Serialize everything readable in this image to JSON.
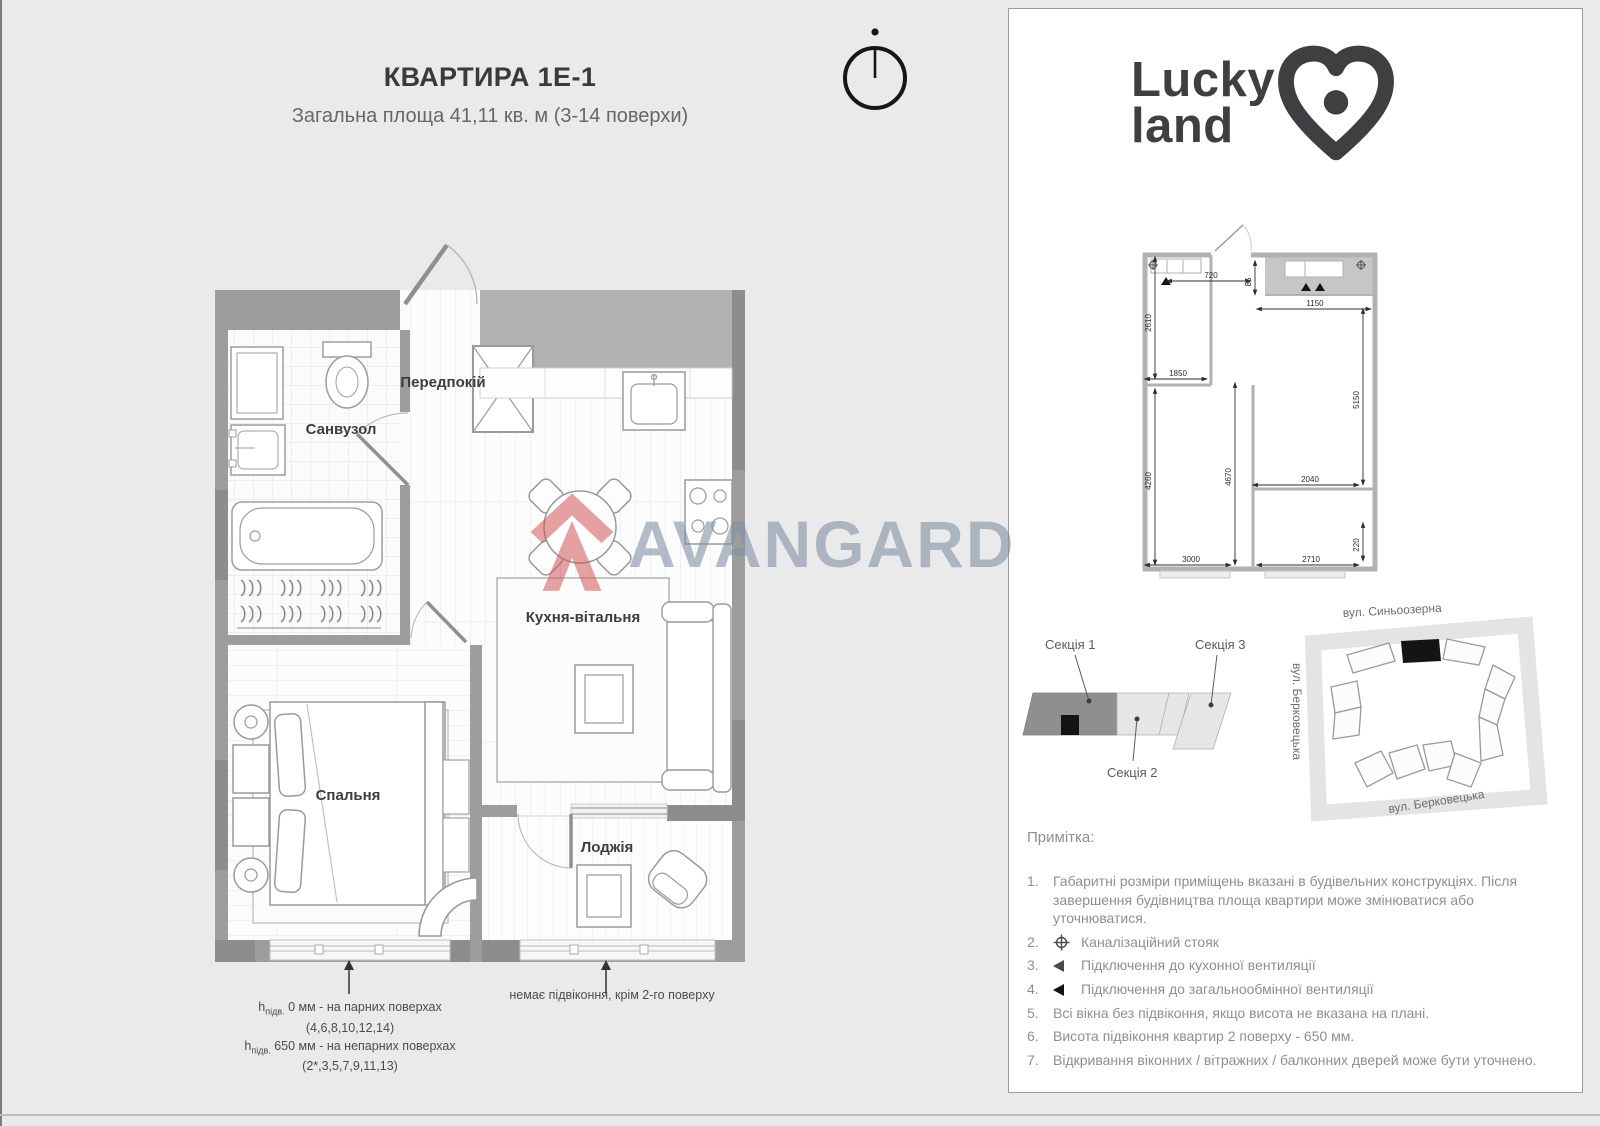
{
  "header": {
    "title": "КВАРТИРА 1Е-1",
    "subtitle": "Загальна площа 41,11 кв. м (3-14 поверхи)"
  },
  "floor_plan": {
    "rooms": {
      "hallway": "Передпокій",
      "bathroom": "Санвузол",
      "kitchen_living": "Кухня-вітальня",
      "bedroom": "Спальня",
      "loggia": "Лоджія"
    },
    "sill_notes": {
      "h": "h",
      "h_sub": "підв.",
      "left_line1": " 0 мм - на парних поверхах",
      "left_line1_floors": "(4,6,8,10,12,14)",
      "left_line2": " 650 мм - на непарних поверхах",
      "left_line2_floors": "(2*,3,5,7,9,11,13)",
      "right": "немає підвіконня, крім 2-го поверху"
    }
  },
  "watermark": {
    "brand": "AVANGARD"
  },
  "brand_panel": {
    "logo": {
      "line1": "Lucky",
      "line2": "land"
    },
    "mini_plan": {
      "dimensions": {
        "top": "720",
        "top_small": "85",
        "top_right": "1150",
        "left_upper": "2610",
        "bath_width": "1850",
        "left_lower": "4260",
        "center": "4670",
        "right": "5150",
        "mid_right": "2040",
        "right_small": "220",
        "bottom_left": "3000",
        "bottom_right": "2710"
      }
    },
    "sections": {
      "s1": "Секція 1",
      "s2": "Секція 2",
      "s3": "Секція 3"
    },
    "map": {
      "street_top": "вул. Синьоозерна",
      "street_left": "вул. Берковецька",
      "street_bottom": "вул. Берковецька"
    },
    "notes": {
      "heading": "Примітка:",
      "items": [
        {
          "num": "1.",
          "text": "Габаритні розміри приміщень вказані в будівельних конструкціях. Після завершення будівництва площа квартири може змінюватися або уточнюватися."
        },
        {
          "num": "2.",
          "text": "Каналізаційний стояк"
        },
        {
          "num": "3.",
          "text": "Підключення до кухонної вентиляції"
        },
        {
          "num": "4.",
          "text": "Підключення до загальнообмінної вентиляції"
        },
        {
          "num": "5.",
          "text": "Всі вікна без підвіконня, якщо висота не вказана на плані."
        },
        {
          "num": "6.",
          "text": "Висота підвіконня квартир 2 поверху - 650 мм."
        },
        {
          "num": "7.",
          "text": "Відкривання віконних / вітражних / балконних дверей може бути уточнено."
        }
      ]
    }
  }
}
